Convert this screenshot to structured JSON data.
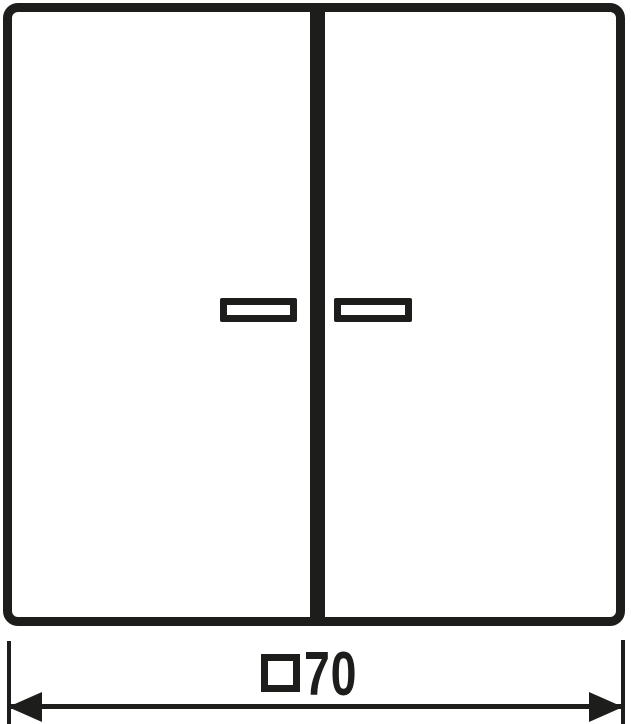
{
  "colors": {
    "line": "#1d1d1b",
    "background": "#ffffff"
  },
  "drawing": {
    "dimension": {
      "symbol": "□",
      "value": "70",
      "label": "□70"
    }
  }
}
